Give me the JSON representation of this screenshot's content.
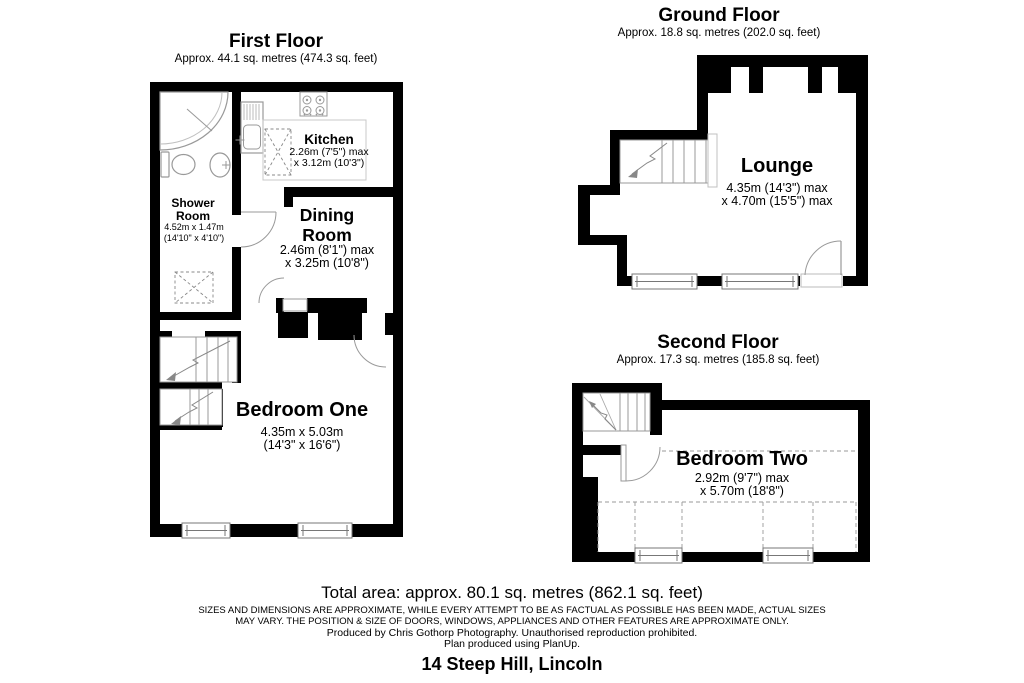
{
  "colors": {
    "wall": "#000000",
    "fixture_line": "#999999",
    "counter_line": "#c0c0c0"
  },
  "first_floor": {
    "title": "First Floor",
    "area": "Approx. 44.1 sq. metres (474.3 sq. feet)",
    "rooms": {
      "shower_room": {
        "name": "Shower Room",
        "dim1": "4.52m x 1.47m",
        "dim2": "(14'10\" x 4'10\")"
      },
      "kitchen": {
        "name": "Kitchen",
        "dim1": "2.26m (7'5\") max",
        "dim2": "x 3.12m (10'3\")"
      },
      "dining_room": {
        "name": "Dining Room",
        "dim1": "2.46m (8'1\") max",
        "dim2": "x 3.25m (10'8\")"
      },
      "bedroom_one": {
        "name": "Bedroom One",
        "dim1": "4.35m x 5.03m",
        "dim2": "(14'3\" x 16'6\")"
      }
    }
  },
  "ground_floor": {
    "title": "Ground Floor",
    "area": "Approx. 18.8 sq. metres (202.0 sq. feet)",
    "rooms": {
      "lounge": {
        "name": "Lounge",
        "dim1": "4.35m (14'3\") max",
        "dim2": "x 4.70m (15'5\") max"
      }
    }
  },
  "second_floor": {
    "title": "Second Floor",
    "area": "Approx. 17.3 sq. metres (185.8 sq. feet)",
    "rooms": {
      "bedroom_two": {
        "name": "Bedroom Two",
        "dim1": "2.92m (9'7\") max",
        "dim2": "x 5.70m (18'8\")"
      }
    }
  },
  "footer": {
    "total_area": "Total area: approx. 80.1 sq. metres (862.1 sq. feet)",
    "disclaimer_line1": "SIZES AND DIMENSIONS ARE APPROXIMATE, WHILE EVERY ATTEMPT TO BE AS FACTUAL AS POSSIBLE HAS BEEN MADE, ACTUAL SIZES",
    "disclaimer_line2": "MAY VARY. THE POSITION & SIZE OF DOORS, WINDOWS, APPLIANCES AND OTHER FEATURES ARE APPROXIMATE ONLY.",
    "produced_by": "Produced by Chris Gothorp Photography. Unauthorised reproduction prohibited.",
    "software": "Plan produced using PlanUp.",
    "address": "14 Steep Hill, Lincoln"
  }
}
